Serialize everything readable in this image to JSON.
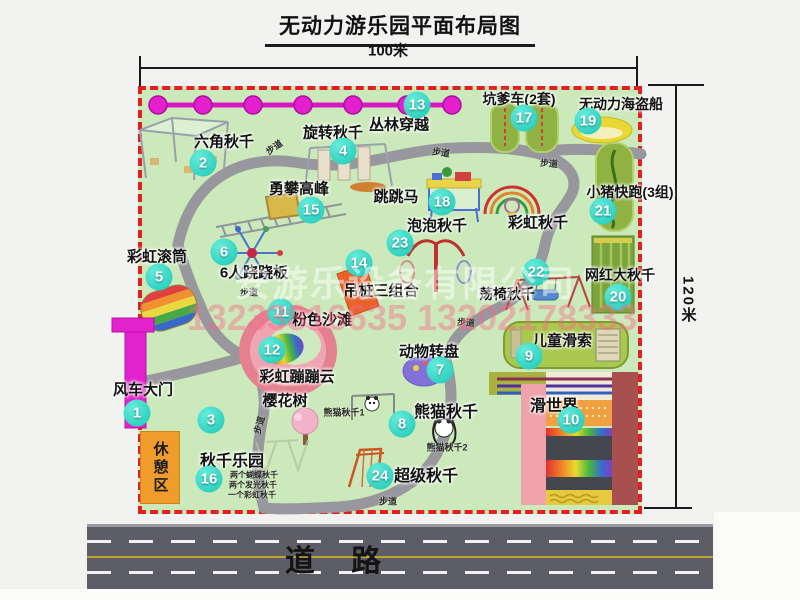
{
  "title": "无动力游乐园平面布局图",
  "dimensions": {
    "width_label": "100米",
    "height_label": "120米"
  },
  "road": {
    "label": "道 路"
  },
  "rest_area": {
    "label": "休憩区",
    "color": "#f09c2c"
  },
  "watermark": {
    "company": "安游乐设备有限公司",
    "phone": "13233816635 13202178333"
  },
  "colors": {
    "map_green": "#cbe9ba",
    "border_red": "#e02020",
    "marker_teal": "#1cc7b5",
    "chain_magenta": "#e31fce",
    "road_gray": "#5d5d67",
    "rest_orange": "#f09c2c",
    "track_green": "#90b243",
    "beach_pink": "#e5818f"
  },
  "map": {
    "walkway": {
      "text": "步道",
      "positions": [
        [
          274,
          147,
          -35
        ],
        [
          441,
          152,
          8
        ],
        [
          549,
          163,
          5
        ],
        [
          249,
          292,
          0
        ],
        [
          466,
          322,
          5
        ],
        [
          259,
          425,
          -75
        ],
        [
          388,
          501,
          0
        ]
      ]
    },
    "attractions": [
      {
        "id": "1",
        "name": "风车大门",
        "marker_pos": [
          137,
          413
        ],
        "label_pos": [
          143,
          389
        ],
        "size": 15
      },
      {
        "id": "2",
        "name": "六角秋千",
        "marker_pos": [
          203,
          163
        ],
        "label_pos": [
          224,
          141
        ],
        "size": 15
      },
      {
        "id": "3",
        "name": "樱花树",
        "marker_pos": [
          211,
          420
        ],
        "label_pos": [
          285,
          400
        ],
        "size": 15
      },
      {
        "id": "4",
        "name": "旋转秋千",
        "marker_pos": [
          343,
          151
        ],
        "label_pos": [
          333,
          132
        ],
        "size": 15
      },
      {
        "id": "5",
        "name": "彩虹滚筒",
        "marker_pos": [
          159,
          277
        ],
        "label_pos": [
          157,
          256
        ],
        "size": 15
      },
      {
        "id": "6",
        "name": "6人跷跷板",
        "marker_pos": [
          224,
          252
        ],
        "label_pos": [
          254,
          272
        ],
        "size": 15
      },
      {
        "id": "7",
        "name": "动物转盘",
        "marker_pos": [
          440,
          370
        ],
        "label_pos": [
          429,
          351
        ],
        "size": 15
      },
      {
        "id": "8",
        "name": "熊猫秋千",
        "marker_pos": [
          402,
          424
        ],
        "label_pos": [
          446,
          410
        ],
        "size": 16
      },
      {
        "id": "9",
        "name": "儿童滑索",
        "marker_pos": [
          529,
          356
        ],
        "label_pos": [
          562,
          340
        ],
        "size": 15
      },
      {
        "id": "10",
        "name": "滑世界",
        "marker_pos": [
          571,
          420
        ],
        "label_pos": [
          554,
          404
        ],
        "size": 16
      },
      {
        "id": "11",
        "name": "粉色沙滩",
        "marker_pos": [
          281,
          312
        ],
        "label_pos": [
          322,
          319
        ],
        "size": 15
      },
      {
        "id": "12",
        "name": "彩虹蹦蹦云",
        "marker_pos": [
          272,
          350
        ],
        "label_pos": [
          297,
          376
        ],
        "size": 15
      },
      {
        "id": "13",
        "name": "丛林穿越",
        "marker_pos": [
          417,
          105
        ],
        "label_pos": [
          399,
          124
        ],
        "size": 15
      },
      {
        "id": "14",
        "name": "吊桩三组合",
        "marker_pos": [
          359,
          263
        ],
        "label_pos": [
          381,
          290
        ],
        "size": 15
      },
      {
        "id": "15",
        "name": "勇攀高峰",
        "marker_pos": [
          311,
          210
        ],
        "label_pos": [
          299,
          188
        ],
        "size": 15
      },
      {
        "id": "16",
        "name": "秋千乐园",
        "marker_pos": [
          209,
          479
        ],
        "label_pos": [
          232,
          459
        ],
        "size": 16
      },
      {
        "id": "17",
        "name": "坑爹车(2套)",
        "marker_pos": [
          524,
          118
        ],
        "label_pos": [
          519,
          99
        ],
        "size": 14
      },
      {
        "id": "18",
        "name": "跳跳马",
        "marker_pos": [
          442,
          202
        ],
        "label_pos": [
          396,
          196
        ],
        "size": 15
      },
      {
        "id": "19",
        "name": "无动力海盗船",
        "marker_pos": [
          588,
          121
        ],
        "label_pos": [
          621,
          104
        ],
        "size": 14
      },
      {
        "id": "20",
        "name": "网红大秋千",
        "marker_pos": [
          618,
          297
        ],
        "label_pos": [
          620,
          275
        ],
        "size": 14
      },
      {
        "id": "21",
        "name": "小猪快跑(3组)",
        "marker_pos": [
          603,
          211
        ],
        "label_pos": [
          630,
          192
        ],
        "size": 14
      },
      {
        "id": "22",
        "name": "荡椅秋千",
        "marker_pos": [
          536,
          272
        ],
        "label_pos": [
          507,
          294
        ],
        "size": 14
      },
      {
        "id": "23",
        "name": "泡泡秋千",
        "marker_pos": [
          400,
          243
        ],
        "label_pos": [
          437,
          225
        ],
        "size": 15
      },
      {
        "id": "24",
        "name": "超级秋千",
        "marker_pos": [
          380,
          476
        ],
        "label_pos": [
          426,
          474
        ],
        "size": 16
      },
      {
        "id": null,
        "name": "彩虹秋千",
        "marker_pos": null,
        "label_pos": [
          538,
          222
        ],
        "size": 15
      }
    ],
    "small_labels": [
      {
        "text": "熊猫秋千1",
        "x": 344,
        "y": 412,
        "size": 9,
        "name": "panda-swing-1-label"
      },
      {
        "text": "熊猫秋千2",
        "x": 447,
        "y": 447,
        "size": 9,
        "name": "panda-swing-2-label"
      },
      {
        "text": "两个蝴蝶秋千",
        "x": 254,
        "y": 475,
        "size": 8,
        "name": "swing-park-detail-1"
      },
      {
        "text": "两个发光秋千",
        "x": 253,
        "y": 485,
        "size": 8,
        "name": "swing-park-detail-2"
      },
      {
        "text": "一个彩虹秋千",
        "x": 252,
        "y": 495,
        "size": 8,
        "name": "swing-park-detail-3"
      }
    ]
  }
}
